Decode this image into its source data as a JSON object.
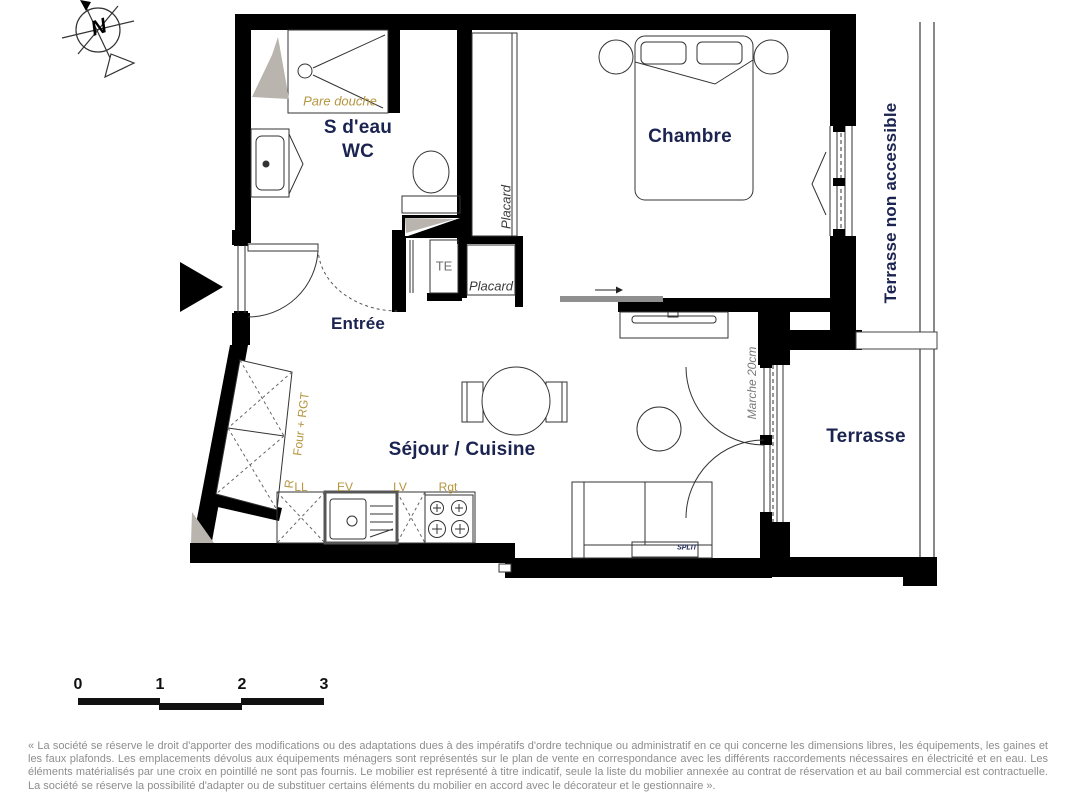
{
  "plan": {
    "compass": {
      "label": "N"
    },
    "rooms": {
      "bathroom_line1": "S d'eau",
      "bathroom_line2": "WC",
      "entry": "Entrée",
      "living": "Séjour / Cuisine",
      "bedroom": "Chambre",
      "terrace": "Terrasse",
      "terrace_upper": "Terrasse non accessible"
    },
    "annotations": {
      "pare_douche": "Pare douche",
      "placard_tall": "Placard",
      "placard_small": "Placard",
      "te": "TE",
      "four_rgt": "Four + RGT",
      "r": "R",
      "ll": "LL",
      "ev": "EV",
      "lv": "LV",
      "rgt": "Rgt",
      "marche": "Marche 20cm",
      "split": "SPLIT"
    }
  },
  "scale_bar": {
    "ticks": [
      "0",
      "1",
      "2",
      "3"
    ]
  },
  "disclaimer": "« La société se réserve le droit d'apporter des modifications ou des adaptations dues à des impératifs d'ordre technique ou administratif en ce qui concerne les dimensions libres, les équipements, les gaines et les faux plafonds. Les emplacements dévolus aux équipements ménagers sont représentés sur le plan de vente en correspondance avec les différents raccordements nécessaires en électricité et en eau. Les éléments matérialisés par une croix en pointillé ne sont pas fournis. Le mobilier est représenté à titre indicatif, seule la liste du mobilier annexée au contrat de réservation et au bail commercial est contractuelle. La société se réserve la possibilité d'adapter ou de substituer certains éléments du mobilier en accord avec le décorateur et le gestionnaire ».",
  "colors": {
    "wall": "#000000",
    "room_label": "#1b2350",
    "annotation": "#b5953f",
    "gray_label": "#6f6f6f",
    "disclaimer_text": "#8e8e8e",
    "shaft_gray": "#b9b5ae"
  }
}
